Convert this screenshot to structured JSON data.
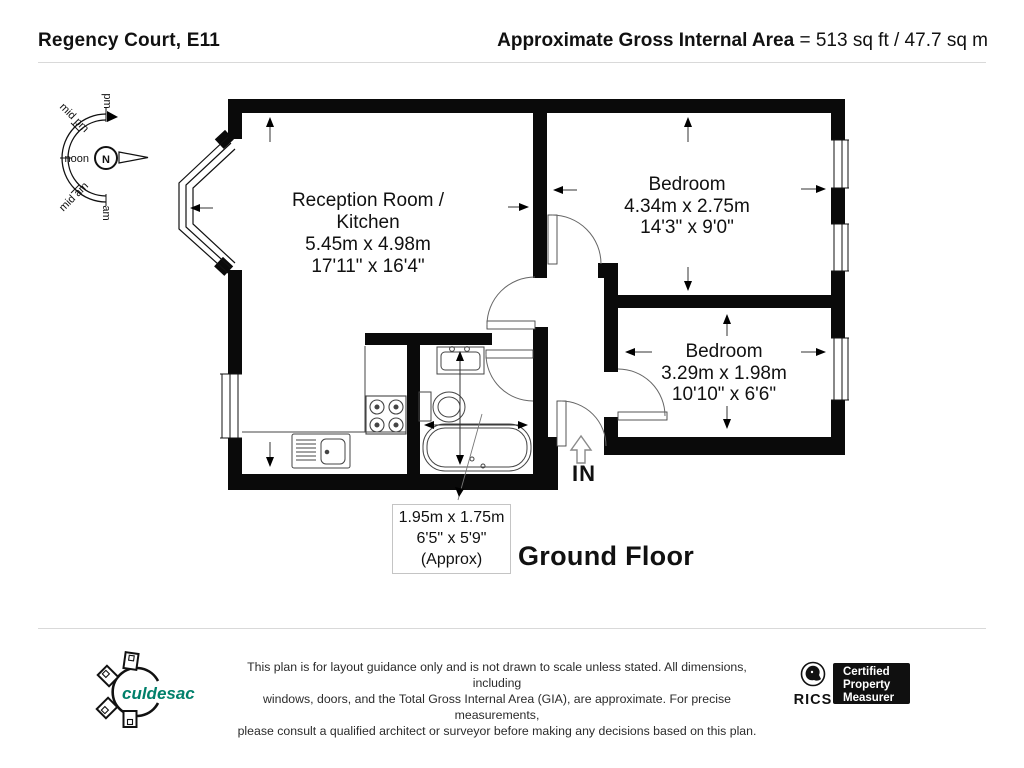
{
  "header": {
    "title": "Regency Court, E11",
    "area_label": "Approximate Gross Internal Area",
    "area_value": " = 513 sq ft / 47.7 sq m"
  },
  "compass": {
    "north": "N",
    "pm": "pm",
    "mid_pm": "mid pm",
    "noon": "noon",
    "mid_am": "mid am",
    "am": "am"
  },
  "rooms": {
    "reception": {
      "name_line1": "Reception Room /",
      "name_line2": "Kitchen",
      "metric": "5.45m x 4.98m",
      "imperial": "17'11\" x 16'4\""
    },
    "bedroom1": {
      "name": "Bedroom",
      "metric": "4.34m x 2.75m",
      "imperial": "14'3\" x 9'0\""
    },
    "bedroom2": {
      "name": "Bedroom",
      "metric": "3.29m x 1.98m",
      "imperial": "10'10\" x 6'6\""
    },
    "bathroom": {
      "metric": "1.95m x 1.75m",
      "imperial": "6'5\" x 5'9\"",
      "approx": "(Approx)"
    }
  },
  "entrance": {
    "label": "IN"
  },
  "floor_label": "Ground Floor",
  "footer": {
    "logo_text": "culdesac",
    "disclaimer_line1": "This plan is for layout guidance only and is not drawn to scale unless stated. All dimensions, including",
    "disclaimer_line2": "windows, doors, and the Total Gross Internal Area (GIA), are approximate. For precise measurements,",
    "disclaimer_line3": "please consult a qualified architect or surveyor before making any decisions based on this plan.",
    "rics_label": "RICS",
    "badge_line1": "Certified",
    "badge_line2": "Property",
    "badge_line3": "Measurer"
  },
  "colors": {
    "accent_teal": "#00806b",
    "wall": "#0a0a0a"
  }
}
